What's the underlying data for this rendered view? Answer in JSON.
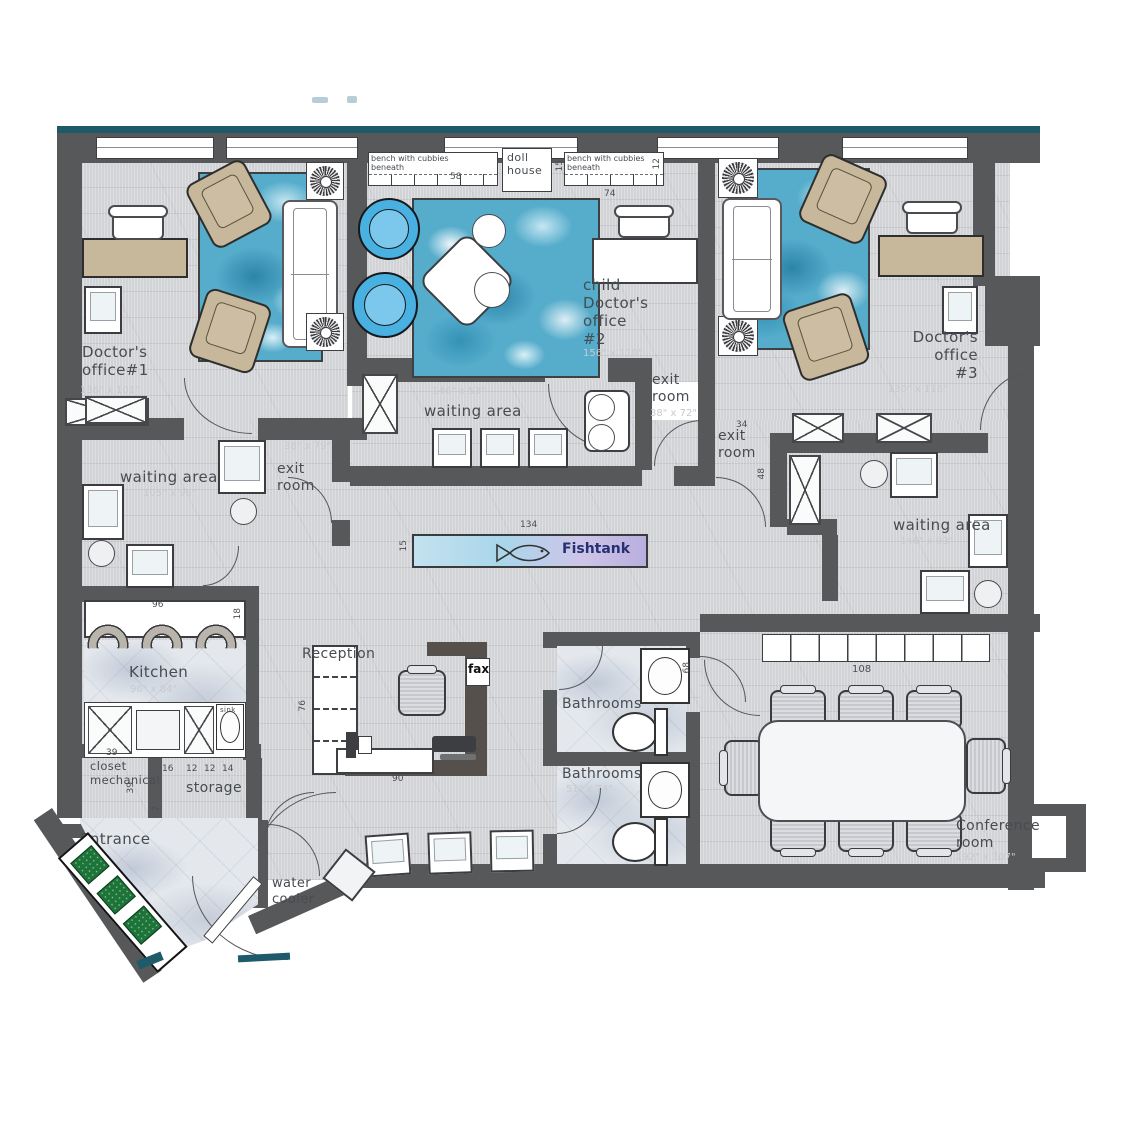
{
  "colors": {
    "wall": "#57585a",
    "accent_teal": "#1f5a6b",
    "water_rug": "#55accb",
    "tan": "#c7b79b",
    "blue_chair": "#49b0e2",
    "green_cushion": "#1d7438",
    "fishtank_text": "#253173"
  },
  "labels": {
    "office1": "Doctor's\noffice#1",
    "office1_dim": "136\" x 101\"",
    "office2": "child\nDoctor's\noffice\n#2",
    "office2_dim": "156\" x 110\"",
    "office3": "Doctor's\noffice\n#3",
    "office3_dim": "130\" x 116\"",
    "waiting_left": "waiting area",
    "waiting_left_dim": "105\" x 96\"",
    "waiting_center": "waiting area",
    "waiting_center_dim": "146\" x 53\"",
    "waiting_right": "waiting area",
    "waiting_right_dim": "146\" x 93\"",
    "exit_left": "exit room",
    "exit_left_dim": "38\" x 79\"",
    "exit_mid": "exit\nroom",
    "exit_mid_dim": "38\" x 72\"",
    "exit_right": "exit\nroom",
    "doll_house": "doll\nhouse",
    "bench_left": "bench with cubbies\nbeneath",
    "bench_right": "bench with cubbies\nbeneath",
    "fishtank": "Fishtank",
    "kitchen": "Kitchen",
    "kitchen_dim": "96\" x 84\"",
    "sink": "sink",
    "closet": "closet\nmechanical",
    "storage": "storage",
    "reception": "Reception",
    "fax": "fax",
    "bathrooms_top": "Bathrooms",
    "bathrooms_bottom": "Bathrooms",
    "bathrooms_bottom_dim": "51\" x 74\"",
    "conference": "Conference\nroom",
    "conference_dim": "192\" x 107\"",
    "entrance": "Entrance",
    "water_cooler": "water\ncooler"
  },
  "dims": {
    "bench_left_w": "58",
    "doll_house_h": "15",
    "bench_right_w": "74",
    "bench_right_h": "12",
    "fishtank_w": "134",
    "fishtank_h": "15",
    "kitchen_w": "96",
    "kitchen_h": "18",
    "reception_h": "76",
    "reception_w": "90",
    "conference_cabinets_w": "108",
    "exit_right_w": "34",
    "exit_right_h": "48",
    "closet_w": "39",
    "closet_h": "39",
    "storage_d1": "16",
    "storage_d2": "12",
    "storage_d3": "12",
    "storage_d4": "14",
    "storage_d5": "7",
    "bathroom_h": "68"
  }
}
